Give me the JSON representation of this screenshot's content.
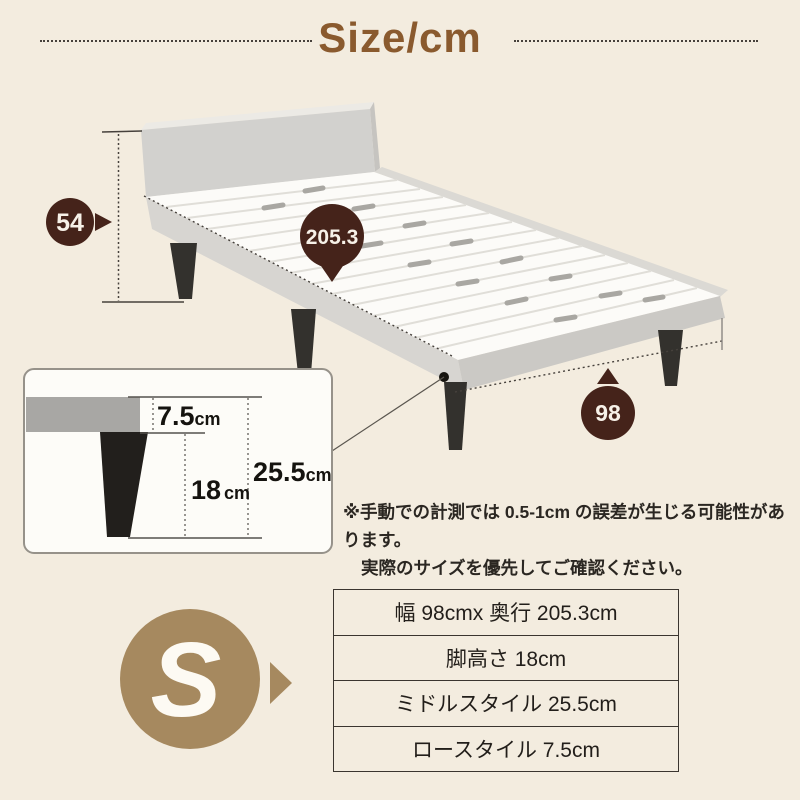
{
  "header": {
    "title": "Size/cm"
  },
  "bed_diagram": {
    "dimension_height": "54",
    "dimension_length": "205.3",
    "dimension_width": "98",
    "leg_inset": {
      "frame_thickness": {
        "value": "7.5",
        "unit": "cm"
      },
      "leg_height": {
        "value": "18",
        "unit": "cm"
      },
      "total_height": {
        "value": "25.5",
        "unit": "cm"
      }
    }
  },
  "note": {
    "line1": "※手動での計測では 0.5-1cm の誤差が生じる可能性があります。",
    "line2": "実際のサイズを優先してご確認ください。"
  },
  "size_badge": {
    "label": "S"
  },
  "spec_table": {
    "rows": [
      "幅 98cmx 奥行 205.3cm",
      "脚高さ 18cm",
      "ミドルスタイル 25.5cm",
      "ロースタイル 7.5cm"
    ]
  },
  "colors": {
    "background": "#f3ecdf",
    "title_brown": "#8a5a2e",
    "badge_dark_brown": "#45231a",
    "badge_tan": "#a6895f",
    "bed_gray": "#d2d1ce",
    "leg_dark": "#33312d",
    "table_border": "#3a352f"
  }
}
